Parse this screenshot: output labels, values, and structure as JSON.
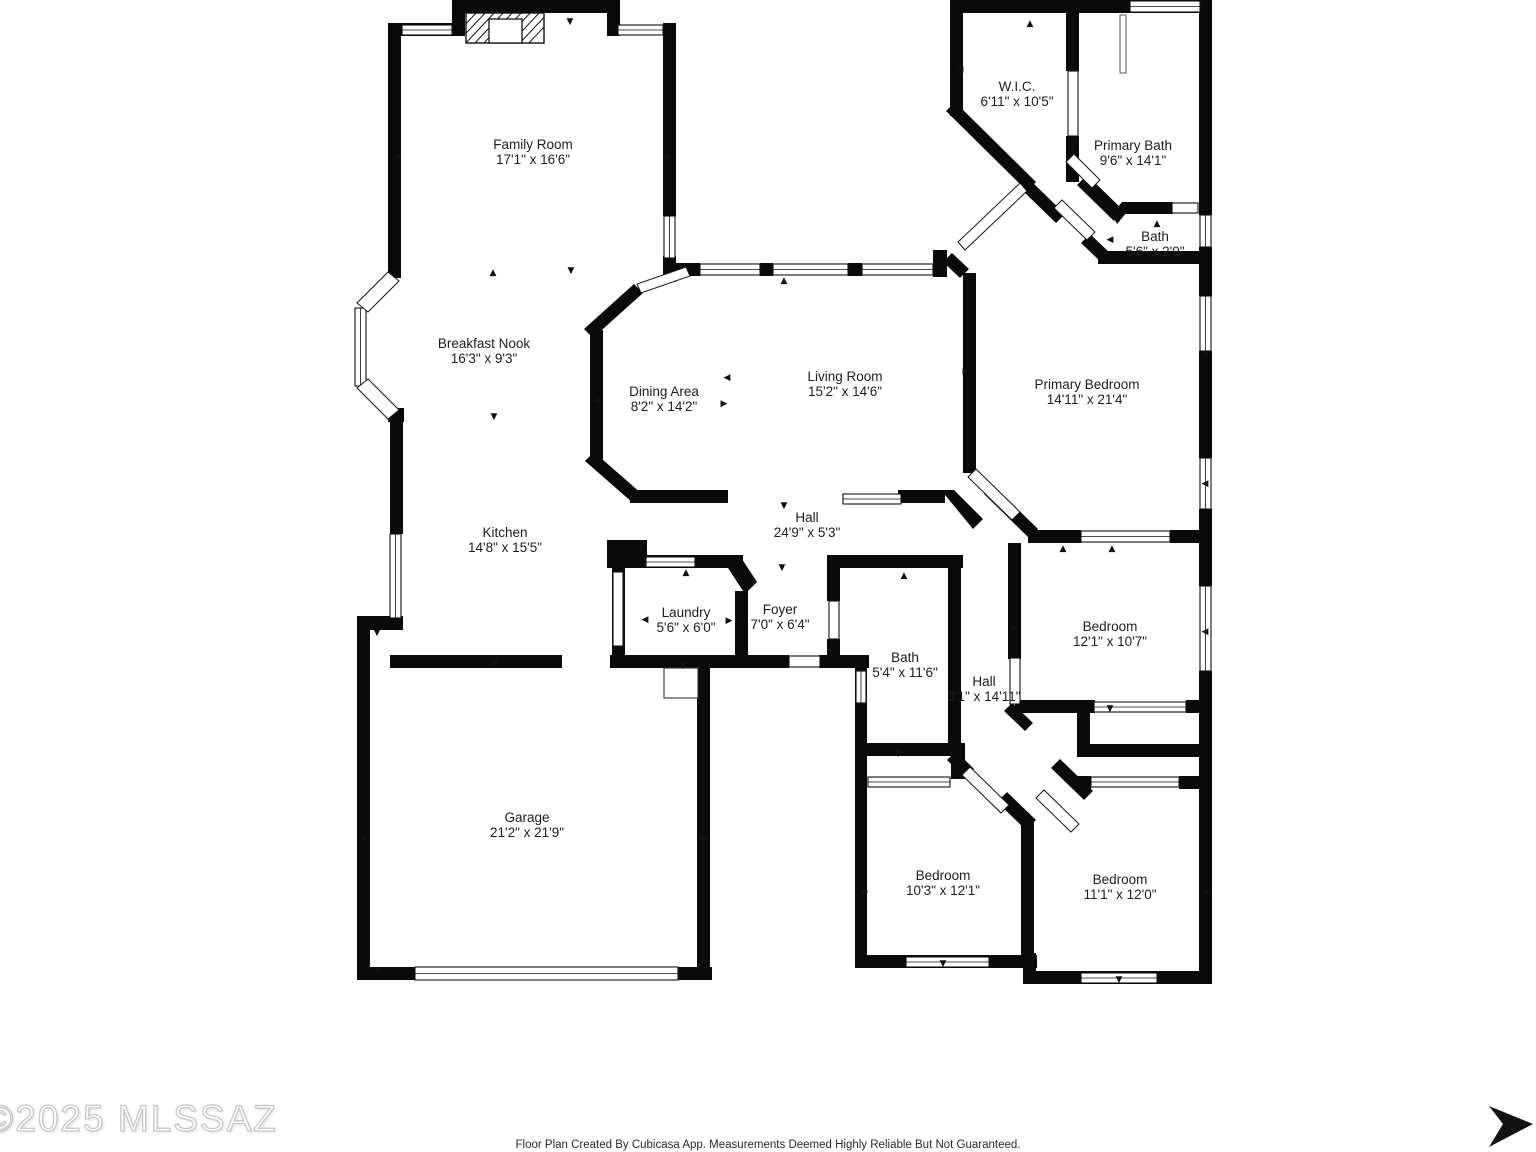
{
  "rooms": [
    {
      "id": "family-room",
      "name": "Family Room",
      "dims": "17'1\" x 16'6\""
    },
    {
      "id": "wic",
      "name": "W.I.C.",
      "dims": "6'11\" x 10'5\""
    },
    {
      "id": "primary-bath",
      "name": "Primary Bath",
      "dims": "9'6\" x 14'1\""
    },
    {
      "id": "bath-2",
      "name": "Bath",
      "dims": "5'6\" x 2'9\""
    },
    {
      "id": "breakfast-nook",
      "name": "Breakfast Nook",
      "dims": "16'3\" x 9'3\""
    },
    {
      "id": "dining-area",
      "name": "Dining Area",
      "dims": "8'2\" x 14'2\""
    },
    {
      "id": "living-room",
      "name": "Living Room",
      "dims": "15'2\" x 14'6\""
    },
    {
      "id": "primary-bedroom",
      "name": "Primary Bedroom",
      "dims": "14'11\" x 21'4\""
    },
    {
      "id": "kitchen",
      "name": "Kitchen",
      "dims": "14'8\" x 15'5\""
    },
    {
      "id": "hall",
      "name": "Hall",
      "dims": "24'9\" x 5'3\""
    },
    {
      "id": "laundry",
      "name": "Laundry",
      "dims": "5'6\" x 6'0\""
    },
    {
      "id": "foyer",
      "name": "Foyer",
      "dims": "7'0\" x 6'4\""
    },
    {
      "id": "bath",
      "name": "Bath",
      "dims": "5'4\" x 11'6\""
    },
    {
      "id": "hall-2",
      "name": "Hall",
      "dims": "3'1\" x 14'11\""
    },
    {
      "id": "bedroom-ne",
      "name": "Bedroom",
      "dims": "12'1\" x 10'7\""
    },
    {
      "id": "garage",
      "name": "Garage",
      "dims": "21'2\" x 21'9\""
    },
    {
      "id": "bedroom-sw",
      "name": "Bedroom",
      "dims": "10'3\" x 12'1\""
    },
    {
      "id": "bedroom-se",
      "name": "Bedroom",
      "dims": "11'1\" x 12'0\""
    }
  ],
  "watermark": "©2025 MLSSAZ",
  "footer": "Floor Plan Created By Cubicasa App. Measurements Deemed Highly Reliable But Not Guaranteed.",
  "colors": {
    "wall": "#000000",
    "background": "#ffffff",
    "watermark": "#c7c7c7",
    "text": "#1d1d1d"
  },
  "icons": {
    "north_arrow": "right-pointing-arrow",
    "fireplace": "hatched-fireplace-box",
    "water_heater": "small-square"
  }
}
